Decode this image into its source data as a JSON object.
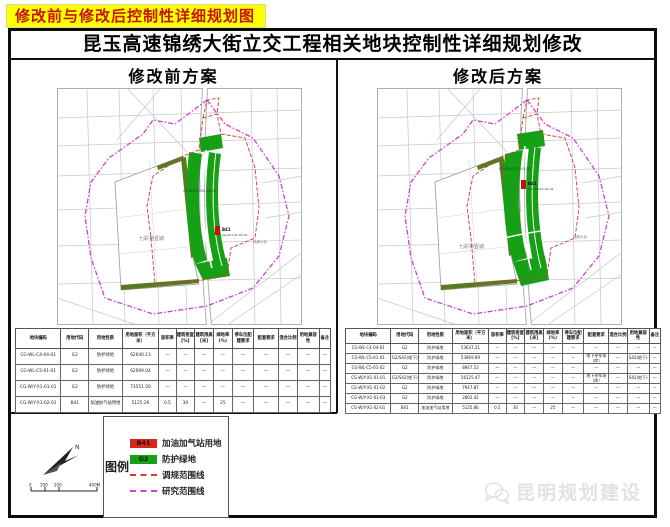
{
  "banner": {
    "text": "修改前与修改后控制性详细规划图"
  },
  "title": "昆玉高速锦绣大街立交工程相关地块控制性详细规划修改",
  "panels": {
    "before": {
      "header": "修改前方案",
      "map_labels": {
        "expressway": "昆玉高速",
        "street": "锦绣大街",
        "area": "七彩第壹城",
        "green_code": "CG-W/Y-X1-01-01 G2",
        "marker_code": "CG-W/Y-X1-02-01",
        "marker": "B41"
      }
    },
    "after": {
      "header": "修改后方案",
      "map_labels": {
        "expressway": "昆玉高速",
        "street": "锦绣大街",
        "area": "七彩第壹城",
        "green_code": "CG-WL-C5-01-01 G2",
        "marker_code": "CG-W/Y-X1-02-01",
        "marker": "B41"
      }
    }
  },
  "table_headers": [
    "地块编码",
    "用地代码",
    "用地性质",
    "用地面积（平方米）",
    "容积率",
    "建筑密度[%]",
    "建筑限高[米]",
    "绿地率(%)",
    "停车位配建要求",
    "配套要求",
    "混合比例",
    "用地兼容性",
    "备注"
  ],
  "tables": {
    "before": {
      "rows": [
        [
          "CG-WL-C4-04-01",
          "G2",
          "防护绿地",
          "62640.13",
          "—",
          "—",
          "—",
          "—",
          "—",
          "—",
          "—",
          "—",
          "—"
        ],
        [
          "CG-WL-C5-01-01",
          "G2",
          "防护绿地",
          "62099.04",
          "—",
          "—",
          "—",
          "—",
          "—",
          "—",
          "—",
          "—",
          "—"
        ],
        [
          "CG-W/Y-X1-01-01",
          "G2",
          "防护绿地",
          "73551.50",
          "—",
          "—",
          "—",
          "—",
          "—",
          "—",
          "—",
          "—",
          "—"
        ],
        [
          "CG-W/Y-X1-02-01",
          "B41",
          "加油加气站用地",
          "5125.26",
          "0.5",
          "30",
          "—",
          "25",
          "—",
          "—",
          "—",
          "—",
          "—"
        ]
      ]
    },
    "after": {
      "rows": [
        [
          "CG-WL-C4-04-01",
          "G2",
          "防护绿地",
          "53637.21",
          "—",
          "—",
          "—",
          "—",
          "—",
          "—",
          "—",
          "—",
          "—"
        ],
        [
          "CG-WL-C5-01-01",
          "G2/S42(地下)",
          "防护绿地",
          "53869.89",
          "—",
          "—",
          "—",
          "—",
          "—",
          "地下停车场（库）",
          "—",
          "S42(地下)",
          "—"
        ],
        [
          "CG-WL-C5-01-02",
          "G2",
          "防护绿地",
          "8947.53",
          "—",
          "—",
          "—",
          "—",
          "—",
          "—",
          "—",
          "—",
          "—"
        ],
        [
          "CG-W/Y-X1-01-01",
          "G2/S42(地下)",
          "防护绿地",
          "56125.47",
          "—",
          "—",
          "—",
          "—",
          "—",
          "地下停车场（库）",
          "—",
          "S42(地下)",
          "—"
        ],
        [
          "CG-W/Y-X1-01-02",
          "G2",
          "防护绿地",
          "7947.87",
          "—",
          "—",
          "—",
          "—",
          "—",
          "—",
          "—",
          "—",
          "—"
        ],
        [
          "CG-W/Y-X1-01-03",
          "G2",
          "防护绿地",
          "2802.42",
          "—",
          "—",
          "—",
          "—",
          "—",
          "—",
          "—",
          "—",
          "—"
        ],
        [
          "CG-W/Y-X1-02-01",
          "B41",
          "加油加气站用地",
          "5125.86",
          "0.5",
          "30",
          "—",
          "25",
          "—",
          "—",
          "—",
          "—",
          "—"
        ]
      ]
    }
  },
  "legend": {
    "title": "图例",
    "items": [
      {
        "code": "B41",
        "label": "加油加气站用地",
        "color": "#d9251c",
        "type": "swatch"
      },
      {
        "code": "G2",
        "label": "防护绿地",
        "color": "#16a016",
        "type": "swatch"
      },
      {
        "code": "",
        "label": "调规范围线",
        "color": "#d43c2f",
        "type": "dashed-line"
      },
      {
        "code": "",
        "label": "研究范围线",
        "color": "#cf3fd0",
        "type": "dashed-line"
      }
    ]
  },
  "scale_bar": {
    "labels": [
      "0",
      "100",
      "200",
      "400M"
    ]
  },
  "watermark": {
    "text": "昆明规划建设"
  },
  "colors": {
    "banner_bg": "#ffff00",
    "banner_text": "#c41606",
    "green_land": "#16a016",
    "gas_station_red": "#d9251c",
    "adjust_boundary_red": "#d43c2f",
    "research_boundary_magenta": "#cf3fd0",
    "olive_strip": "#5a7a1f"
  }
}
